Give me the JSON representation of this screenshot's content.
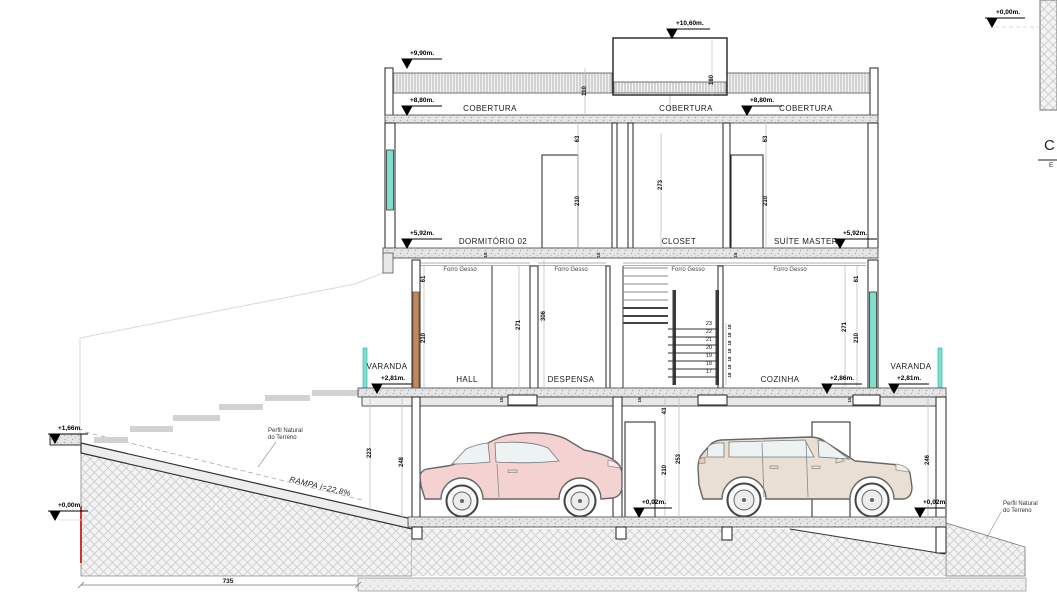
{
  "drawing": {
    "levels": {
      "l1060": "+10,60m.",
      "l990": "+9,90m.",
      "l880": "+8,80m.",
      "l592": "+5,92m.",
      "l286": "+2,86m.",
      "l281": "+2,81m.",
      "l166": "+1,66m.",
      "l002": "+0,02m.",
      "l000": "+0,00m."
    },
    "rooms": {
      "cobertura": "COBERTURA",
      "dormitorio": "DORMITÓRIO 02",
      "closet": "CLOSET",
      "suite": "SUÍTE MASTER",
      "varanda": "VARANDA",
      "hall": "HALL",
      "despensa": "DESPENSA",
      "cozinha": "COZINHA",
      "forro": "Forro Gesso"
    },
    "dims": {
      "parapet_h": "110",
      "bulkhead_h": "180",
      "lintel_top": "63",
      "door_h": "210",
      "closet_h": "273",
      "slab_t": "15",
      "lintel_first": "61",
      "wall_h": "271",
      "hall_h": "306",
      "garage_lintel": "43",
      "garage_ceiling": "253",
      "left_a": "223",
      "left_b": "248",
      "right_a": "246",
      "total_w": "735"
    },
    "stairs": {
      "treads": [
        "23",
        "22",
        "21",
        "20",
        "19",
        "18",
        "17"
      ],
      "riser": "18"
    },
    "annotations": {
      "perfil_line1": "Perfil Natural",
      "perfil_line2": "do Terreno",
      "rampa": "RAMPA i=22,8%",
      "title_c": "C",
      "title_e": "E"
    },
    "colors": {
      "glass": "#7FDFCB",
      "wood": "#C08A5E",
      "car_sedan": "#F5D2D2",
      "car_suv": "#E9DFD2",
      "accent_red": "#CC3333"
    }
  }
}
